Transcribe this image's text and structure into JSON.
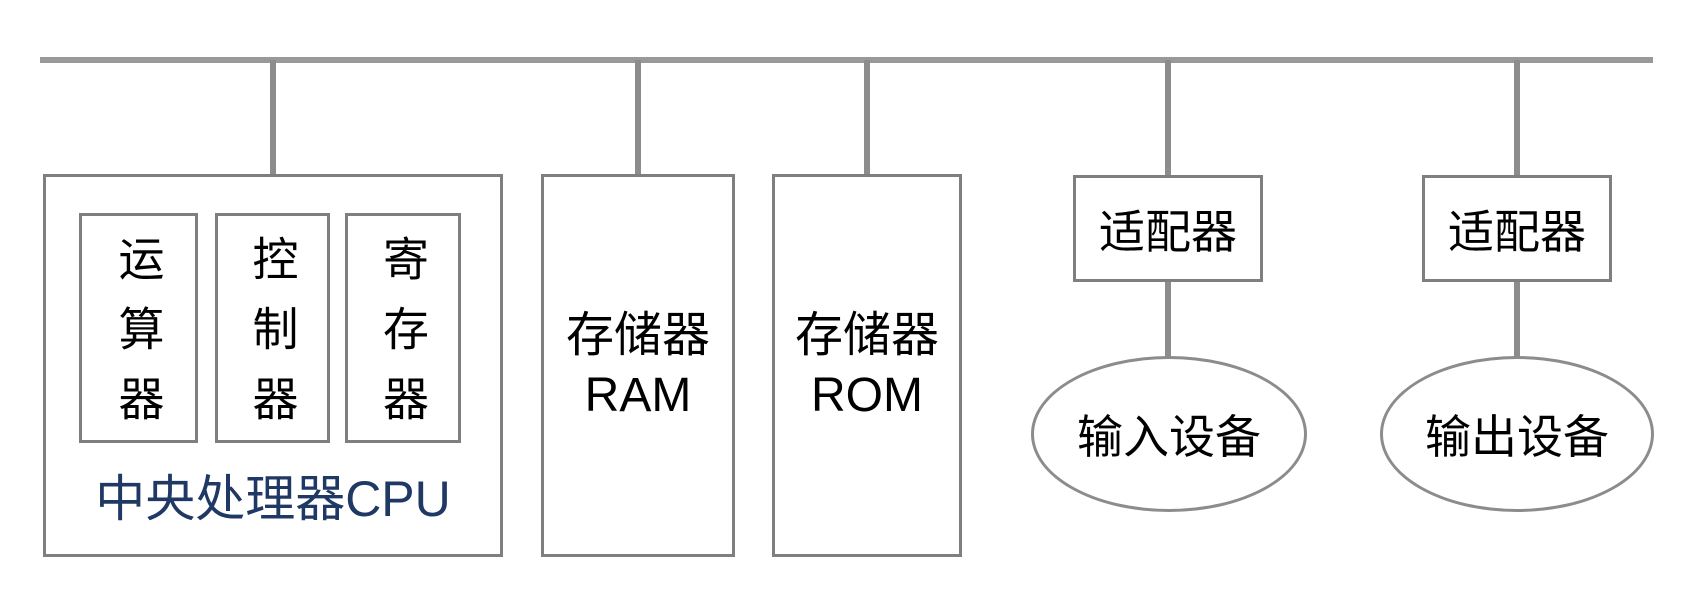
{
  "diagram_type": "computer-architecture-bus-diagram",
  "colors": {
    "background": "#ffffff",
    "bus_line": "#999999",
    "connector_line": "#8c8c8c",
    "box_border": "#7f7f7f",
    "ellipse_border": "#8c8c8c",
    "text": "#000000",
    "cpu_label_text": "#1f3864"
  },
  "nodes": {
    "cpu": {
      "label": "中央处理器CPU",
      "units": [
        {
          "label": "运算器"
        },
        {
          "label": "控制器"
        },
        {
          "label": "寄存器"
        }
      ]
    },
    "ram": {
      "line1": "存储器",
      "line2": "RAM"
    },
    "rom": {
      "line1": "存储器",
      "line2": "ROM"
    },
    "input_adapter": {
      "label": "适配器"
    },
    "output_adapter": {
      "label": "适配器"
    },
    "input_device": {
      "label": "输入设备"
    },
    "output_device": {
      "label": "输出设备"
    }
  }
}
